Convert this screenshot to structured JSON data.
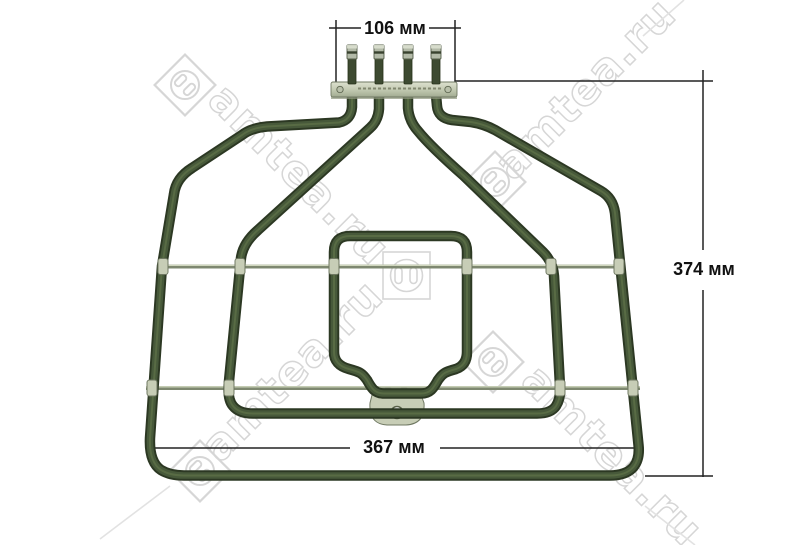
{
  "image": {
    "type": "product-photo",
    "subject": "oven grill heating element with mounting bracket, four terminals, support rods and mounting tab",
    "background": "#ffffff"
  },
  "dimensions": {
    "top_width_label": "106 мм",
    "height_label": "374 мм",
    "bottom_width_label": "367 мм"
  },
  "watermark": {
    "text": "amtea.ru",
    "logo": "socket-in-square",
    "color": "#d6d6d6"
  },
  "colors": {
    "background": "#ffffff",
    "tube_dark": "#2c3823",
    "tube_mid": "#47593a",
    "tube_light": "#6d8153",
    "metal_light": "#c7cdb6",
    "metal_border": "#6f7862",
    "watermark": "#d6d6d6",
    "dimension_line": "#222222",
    "dimension_text": "#111111"
  }
}
